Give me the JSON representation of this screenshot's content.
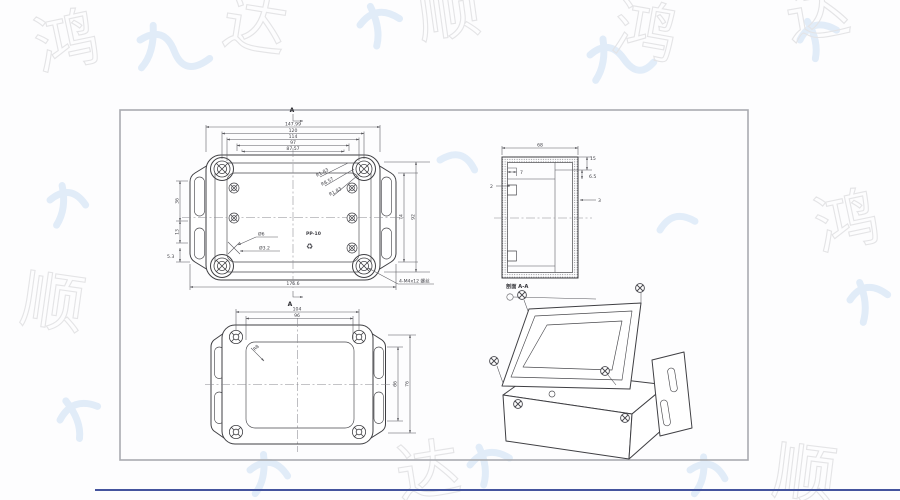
{
  "watermark": {
    "chars": [
      "鸿",
      "达",
      "顺",
      "鸿",
      "达",
      "顺",
      "鸿",
      "达",
      "顺"
    ]
  },
  "drawing": {
    "top_view": {
      "section_mark_top": "A",
      "section_mark_bottom": "A",
      "dims_top": [
        "147.99",
        "120",
        "114",
        "97",
        "87.57"
      ],
      "dim_bottom": "176.6",
      "dims_left": [
        "36",
        "13",
        "5.3"
      ],
      "dims_right": [
        "74",
        "92"
      ],
      "radius_labels": [
        "R1.83",
        "R8.57",
        "R1.83"
      ],
      "hole_labels": [
        "Ø6",
        "Ø3.2"
      ],
      "material_mark": "PP-10",
      "recycle_icon": "♻",
      "note": "4-M4x12 螺丝"
    },
    "section_view": {
      "title": "剖面 A-A",
      "dim_top": "68",
      "dims_right": [
        "15",
        "6.5",
        "3"
      ],
      "dims_left": [
        "7",
        "2"
      ]
    },
    "bottom_view": {
      "dims_top": [
        "104",
        "96"
      ],
      "dims_right": [
        "66",
        "76"
      ],
      "radius_label": "R8"
    }
  },
  "colors": {
    "line": "#3f3f43",
    "frame": "#a9abb0",
    "watermark_gray": "#e4e4e6",
    "watermark_blue": "#dbe8f7",
    "accent_blue": "#44549e"
  }
}
